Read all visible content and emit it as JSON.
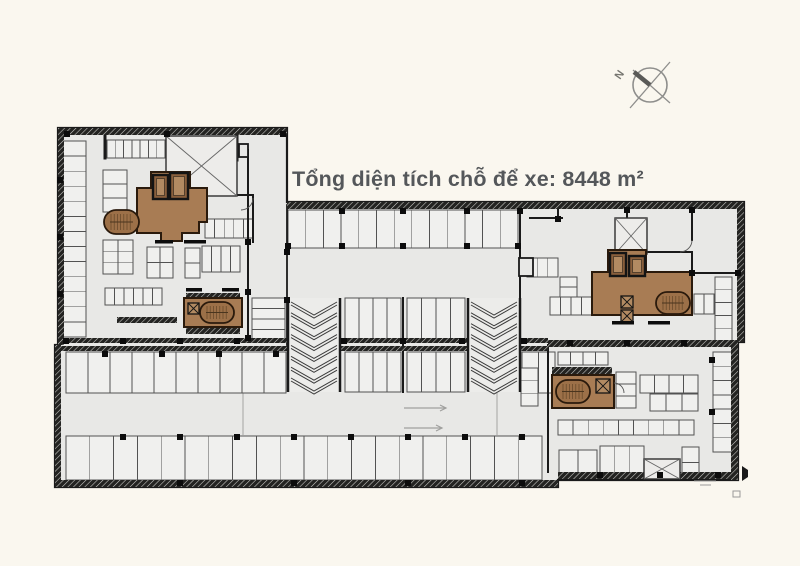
{
  "title": {
    "text": "Tổng diện tích chỗ để xe: 8448 m²"
  },
  "north": {
    "label": "N",
    "cx": 650,
    "cy": 85,
    "r": 17,
    "label_x": 620,
    "label_y": 80,
    "label_rot": -55,
    "chords": [
      [
        670,
        62,
        630,
        108
      ],
      [
        633,
        70,
        670,
        103
      ]
    ],
    "bar": [
      650,
      85,
      634,
      72
    ]
  },
  "colors": {
    "paper": "#faf7ef",
    "floor": "#e8e8e6",
    "stall": "#f0f0ee",
    "line": "#525252",
    "wall": "#1a1a1a",
    "ramp": "#ececea",
    "void_fill": "#edecea",
    "core": "#a87c54",
    "core_dark": "#8a5f3c",
    "core_light": "#b28a62",
    "core_line": "#2a1a0c",
    "gray": "#8e8e8c",
    "title_text": "#54575a"
  },
  "plan": {
    "envelope": "58,128 287,128 287,202 744,202 744,342 738,342 738,480 558,480 558,487 55,487 55,345 58,345",
    "bands": [
      [
        58,
        128,
        229,
        7
      ],
      [
        287,
        202,
        457,
        7
      ],
      [
        58,
        128,
        6,
        217
      ],
      [
        55,
        345,
        6,
        142
      ],
      [
        55,
        480,
        503,
        7
      ],
      [
        558,
        472,
        179,
        7
      ],
      [
        737,
        202,
        7,
        140
      ],
      [
        731,
        342,
        7,
        138
      ],
      [
        58,
        338,
        230,
        5
      ],
      [
        58,
        346,
        230,
        5
      ],
      [
        340,
        338,
        128,
        5
      ],
      [
        340,
        346,
        128,
        5
      ],
      [
        520,
        338,
        28,
        5
      ],
      [
        520,
        346,
        28,
        5
      ],
      [
        548,
        340,
        189,
        7
      ],
      [
        552,
        367,
        60,
        7
      ],
      [
        186,
        293,
        54,
        6
      ],
      [
        186,
        328,
        54,
        6
      ],
      [
        117,
        317,
        60,
        6
      ]
    ],
    "walls": [
      [
        248,
        150,
        248,
        338,
        2
      ],
      [
        287,
        205,
        287,
        345,
        1.8
      ],
      [
        207,
        195,
        253,
        195,
        2
      ],
      [
        253,
        195,
        253,
        242,
        2
      ],
      [
        403,
        298,
        403,
        392,
        2
      ],
      [
        520,
        209,
        520,
        298,
        2
      ],
      [
        548,
        345,
        548,
        472,
        2
      ],
      [
        558,
        205,
        558,
        219,
        2
      ],
      [
        627,
        205,
        627,
        218,
        2
      ],
      [
        530,
        218,
        562,
        218,
        2
      ],
      [
        692,
        209,
        692,
        240,
        2
      ],
      [
        692,
        252,
        692,
        273,
        2
      ],
      [
        692,
        273,
        737,
        273,
        2
      ],
      [
        648,
        252,
        692,
        252,
        2
      ],
      [
        105,
        136,
        105,
        158,
        3
      ],
      [
        237,
        136,
        237,
        160,
        3
      ]
    ],
    "joints": [
      [
        243,
        393,
        243,
        435
      ],
      [
        497,
        393,
        497,
        435
      ]
    ],
    "stalls": [
      {
        "x": 62,
        "y": 141,
        "w": 24,
        "h": 196,
        "rows": 13
      },
      {
        "x": 107,
        "y": 140,
        "w": 58,
        "h": 18,
        "cols": 7
      },
      {
        "x": 103,
        "y": 170,
        "w": 24,
        "h": 42,
        "rows": 3
      },
      {
        "x": 205,
        "y": 219,
        "w": 48,
        "h": 19,
        "cols": 5
      },
      {
        "x": 103,
        "y": 240,
        "w": 30,
        "h": 34,
        "rows": 3,
        "cols": 2
      },
      {
        "x": 147,
        "y": 247,
        "w": 26,
        "h": 31,
        "rows": 2,
        "cols": 2
      },
      {
        "x": 185,
        "y": 248,
        "w": 15,
        "h": 30,
        "rows": 2
      },
      {
        "x": 202,
        "y": 246,
        "w": 38,
        "h": 26,
        "cols": 4
      },
      {
        "x": 105,
        "y": 288,
        "w": 57,
        "h": 17,
        "cols": 6
      },
      {
        "x": 252,
        "y": 298,
        "w": 33,
        "h": 42,
        "rows": 4
      },
      {
        "x": 288,
        "y": 210,
        "w": 230,
        "h": 38,
        "cols": 13
      },
      {
        "x": 345,
        "y": 298,
        "w": 56,
        "h": 43,
        "cols": 4
      },
      {
        "x": 407,
        "y": 298,
        "w": 58,
        "h": 43,
        "cols": 4
      },
      {
        "x": 345,
        "y": 352,
        "w": 56,
        "h": 40,
        "cols": 4
      },
      {
        "x": 407,
        "y": 352,
        "w": 58,
        "h": 40,
        "cols": 4
      },
      {
        "x": 66,
        "y": 352,
        "w": 220,
        "h": 41,
        "cols": 10
      },
      {
        "x": 522,
        "y": 352,
        "w": 33,
        "h": 41,
        "cols": 2
      },
      {
        "x": 66,
        "y": 436,
        "w": 476,
        "h": 44,
        "cols": 20
      },
      {
        "x": 521,
        "y": 368,
        "w": 17,
        "h": 38,
        "rows": 3
      },
      {
        "x": 527,
        "y": 258,
        "w": 31,
        "h": 19,
        "cols": 3
      },
      {
        "x": 560,
        "y": 277,
        "w": 17,
        "h": 20,
        "rows": 2
      },
      {
        "x": 550,
        "y": 297,
        "w": 42,
        "h": 18,
        "cols": 4
      },
      {
        "x": 694,
        "y": 294,
        "w": 30,
        "h": 20,
        "cols": 3
      },
      {
        "x": 715,
        "y": 277,
        "w": 17,
        "h": 64,
        "rows": 5
      },
      {
        "x": 713,
        "y": 352,
        "w": 19,
        "h": 100,
        "rows": 7
      },
      {
        "x": 558,
        "y": 352,
        "w": 50,
        "h": 13,
        "cols": 4
      },
      {
        "x": 616,
        "y": 372,
        "w": 20,
        "h": 36,
        "rows": 3
      },
      {
        "x": 640,
        "y": 375,
        "w": 58,
        "h": 18,
        "cols": 4
      },
      {
        "x": 650,
        "y": 394,
        "w": 48,
        "h": 17,
        "cols": 3
      },
      {
        "x": 558,
        "y": 420,
        "w": 136,
        "h": 15,
        "cols": 9
      },
      {
        "x": 559,
        "y": 450,
        "w": 38,
        "h": 28,
        "cols": 2
      },
      {
        "x": 600,
        "y": 446,
        "w": 44,
        "h": 32,
        "cols": 3
      },
      {
        "x": 682,
        "y": 447,
        "w": 17,
        "h": 31,
        "rows": 2
      }
    ],
    "voids": [
      [
        166,
        136,
        71,
        60
      ],
      [
        615,
        218,
        32,
        36
      ],
      [
        644,
        459,
        36,
        20
      ]
    ],
    "boxes": [
      [
        519,
        258,
        14,
        18
      ],
      [
        239,
        144,
        9,
        13
      ]
    ],
    "ramps": [
      [
        288,
        298,
        52,
        94
      ],
      [
        468,
        298,
        52,
        94
      ]
    ],
    "cores": [
      {
        "name": "core-northwest",
        "blob": "137,188 151,188 151,172 190,172 190,188 207,188 207,222 199,222 199,233 182,233 182,241 161,241 161,233 137,233",
        "elevators": [
          {
            "x": 153,
            "y": 175,
            "w": 15,
            "h": 24
          },
          {
            "x": 170,
            "y": 173,
            "w": 18,
            "h": 26
          }
        ],
        "ovals": [
          {
            "x": 104,
            "y": 210,
            "w": 35,
            "h": 24
          }
        ],
        "xboxes": []
      },
      {
        "name": "core-east",
        "blob": "592,272 608,272 608,250 646,250 646,272 692,272 692,315 592,315",
        "elevators": [
          {
            "x": 610,
            "y": 253,
            "w": 16,
            "h": 23
          },
          {
            "x": 629,
            "y": 256,
            "w": 16,
            "h": 20
          }
        ],
        "ovals": [
          {
            "x": 656,
            "y": 292,
            "w": 34,
            "h": 22
          }
        ],
        "xboxes": [
          {
            "x": 621,
            "y": 296,
            "w": 12,
            "h": 12
          },
          {
            "x": 621,
            "y": 310,
            "w": 12,
            "h": 12
          }
        ]
      },
      {
        "name": "core-southeast",
        "blob": "552,375 614,375 614,408 552,408",
        "elevators": [],
        "ovals": [
          {
            "x": 556,
            "y": 380,
            "w": 34,
            "h": 23
          }
        ],
        "xboxes": [
          {
            "x": 596,
            "y": 379,
            "w": 14,
            "h": 14
          }
        ]
      },
      {
        "name": "core-south",
        "blob": "184,298 242,298 242,327 184,327",
        "ovals": [
          {
            "x": 200,
            "y": 302,
            "w": 34,
            "h": 21
          }
        ],
        "elevators": [],
        "xboxes": [
          {
            "x": 188,
            "y": 303,
            "w": 11,
            "h": 11
          }
        ]
      }
    ],
    "columns": [
      [
        67,
        134
      ],
      [
        167,
        134
      ],
      [
        283,
        134
      ],
      [
        342,
        211
      ],
      [
        403,
        211
      ],
      [
        467,
        211
      ],
      [
        520,
        211
      ],
      [
        558,
        219
      ],
      [
        627,
        210
      ],
      [
        692,
        210
      ],
      [
        288,
        246
      ],
      [
        342,
        246
      ],
      [
        403,
        246
      ],
      [
        467,
        246
      ],
      [
        518,
        246
      ],
      [
        248,
        242
      ],
      [
        248,
        292
      ],
      [
        248,
        338
      ],
      [
        287,
        252
      ],
      [
        287,
        300
      ],
      [
        60,
        180
      ],
      [
        60,
        237
      ],
      [
        60,
        294
      ],
      [
        66,
        341
      ],
      [
        123,
        341
      ],
      [
        180,
        341
      ],
      [
        237,
        341
      ],
      [
        344,
        341
      ],
      [
        403,
        341
      ],
      [
        462,
        341
      ],
      [
        524,
        341
      ],
      [
        570,
        343
      ],
      [
        627,
        343
      ],
      [
        684,
        343
      ],
      [
        105,
        354
      ],
      [
        162,
        354
      ],
      [
        219,
        354
      ],
      [
        276,
        354
      ],
      [
        123,
        437
      ],
      [
        180,
        437
      ],
      [
        237,
        437
      ],
      [
        294,
        437
      ],
      [
        351,
        437
      ],
      [
        408,
        437
      ],
      [
        465,
        437
      ],
      [
        522,
        437
      ],
      [
        180,
        483
      ],
      [
        294,
        483
      ],
      [
        408,
        483
      ],
      [
        522,
        483
      ],
      [
        600,
        475
      ],
      [
        660,
        475
      ],
      [
        718,
        475
      ],
      [
        692,
        273
      ],
      [
        738,
        273
      ],
      [
        712,
        360
      ],
      [
        712,
        412
      ]
    ],
    "dashes": [
      [
        155,
        240,
        18
      ],
      [
        184,
        240,
        22
      ],
      [
        612,
        321,
        22
      ],
      [
        648,
        321,
        22
      ],
      [
        186,
        288,
        16
      ],
      [
        222,
        288,
        17
      ]
    ],
    "arrows": [
      [
        404,
        408,
        42
      ],
      [
        404,
        428,
        38
      ]
    ],
    "door_arcs": [
      "M253,198 A12 12 0 0 1 241,210",
      "M692,240 A12 12 0 0 1 680,252",
      "M614,383 A10 10 0 0 1 624,393"
    ]
  },
  "corner_marks": {
    "lines": [
      [
        694,
        481,
        716,
        481
      ],
      [
        700,
        485,
        711,
        485
      ]
    ],
    "flag": "742,466 742,481 748,477 748,470",
    "box": [
      733,
      491,
      7,
      6
    ]
  }
}
